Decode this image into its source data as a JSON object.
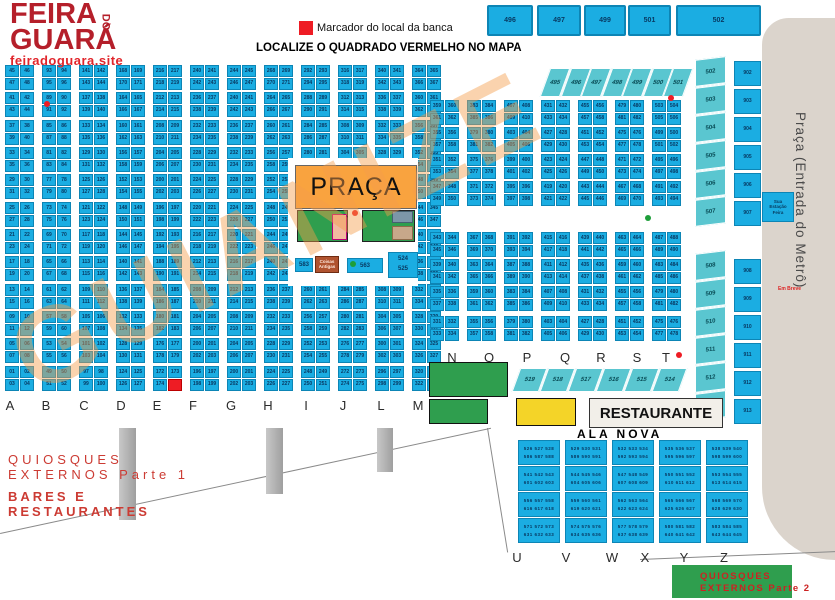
{
  "logo": {
    "line1": "FEIRA",
    "do": "DO",
    "line2": "GUARÁ",
    "site": "feiradoguara.site"
  },
  "legend": {
    "label": "Marcador do local da banca"
  },
  "heading": "LOCALIZE O QUADRADO VERMELHO NO MAPA",
  "watermark_text": "GUIANIZE",
  "colors": {
    "cell": "#1bade2",
    "cell_border": "#0d85b5",
    "marker_red": "#ee1c24",
    "teal": "#5ac6d0",
    "praca_orange": "#f9a33f",
    "green": "#2f9e4e",
    "yellow": "#f4d428",
    "metro_gray": "#dbd4cc",
    "brown": "#b0532f",
    "logo_red": "#b51f2a"
  },
  "top_boxes": [
    {
      "label": "496",
      "x": 487,
      "w": 46
    },
    {
      "label": "497",
      "x": 537,
      "w": 44
    },
    {
      "label": "499",
      "x": 584,
      "w": 42
    },
    {
      "label": "501",
      "x": 628,
      "w": 43
    },
    {
      "label": "502",
      "x": 676,
      "w": 85
    }
  ],
  "left_grid": {
    "block_tops": [
      65,
      92,
      120,
      147,
      174,
      202,
      229,
      256,
      284,
      311,
      338,
      366
    ],
    "cell_w": 14,
    "cell_h": 12,
    "row2_dy": 12.5,
    "letters_y": 398,
    "groups": [
      {
        "letter": "A",
        "x": 5,
        "lx": 10,
        "start": 1
      },
      {
        "letter": "B",
        "x": 42,
        "lx": 46,
        "start": 49
      },
      {
        "letter": "C",
        "x": 79,
        "lx": 84,
        "start": 97
      },
      {
        "letter": "D",
        "x": 116,
        "lx": 121,
        "start": 124
      },
      {
        "letter": "E",
        "x": 153,
        "lx": 157,
        "start": 172
      },
      {
        "letter": "F",
        "x": 190,
        "lx": 193,
        "start": 196
      },
      {
        "letter": "G",
        "x": 227,
        "lx": 231,
        "start": 200
      },
      {
        "letter": "H",
        "x": 264,
        "lx": 268,
        "start": 224
      },
      {
        "letter": "I",
        "x": 301,
        "lx": 306,
        "start": 248
      },
      {
        "letter": "J",
        "x": 338,
        "lx": 343,
        "start": 272
      },
      {
        "letter": "L",
        "x": 375,
        "lx": 381,
        "start": 296
      },
      {
        "letter": "M",
        "x": 412,
        "lx": 418,
        "start": 320
      }
    ]
  },
  "right_grid": {
    "block_tops": [
      100,
      127,
      154,
      181,
      232,
      259,
      286,
      316
    ],
    "cell_w": 14,
    "cell_h": 12,
    "row2_dy": 12.5,
    "letters_y": 350,
    "groups": [
      {
        "letter": "N",
        "x": 430,
        "lx": 452,
        "start": 331
      },
      {
        "letter": "O",
        "x": 467,
        "lx": 489,
        "start": 355
      },
      {
        "letter": "P",
        "x": 504,
        "lx": 527,
        "start": 379
      },
      {
        "letter": "Q",
        "x": 541,
        "lx": 565,
        "start": 403
      },
      {
        "letter": "R",
        "x": 578,
        "lx": 601,
        "start": 427
      },
      {
        "letter": "S",
        "x": 615,
        "lx": 637,
        "start": 451
      },
      {
        "letter": "T",
        "x": 652,
        "lx": 666,
        "start": 475
      }
    ]
  },
  "red_marker": {
    "group_letter": "E",
    "group_index": 4,
    "position": "bottom-right"
  },
  "slant_top": {
    "labels": [
      "495",
      "496",
      "497",
      "498",
      "499",
      "500",
      "501"
    ],
    "x0": 545,
    "step": 20.5,
    "y": 68,
    "w": 20,
    "h": 29
  },
  "slant_bottom": {
    "labels": [
      "519",
      "518",
      "517",
      "516",
      "515",
      "514"
    ],
    "x0": 516,
    "step": 28,
    "y": 368,
    "w": 27,
    "h": 24
  },
  "teal_col": {
    "labels": [
      "502",
      "503",
      "504",
      "505",
      "506",
      "507",
      "508",
      "509",
      "510",
      "511",
      "512",
      "513"
    ],
    "x": 695,
    "w": 31,
    "y0": 58,
    "h": 27,
    "step": 28,
    "gap_after": 6,
    "gap": 26
  },
  "blue_col": {
    "labels": [
      "902",
      "903",
      "904",
      "905",
      "906",
      "907",
      "908",
      "909",
      "910",
      "911",
      "912",
      "913"
    ],
    "x": 734,
    "w": 27,
    "y0": 61,
    "h": 25,
    "step": 28,
    "gap_after": 6,
    "gap": 30
  },
  "praca": {
    "title": "PRAÇA",
    "box583": "583",
    "coisas": "Coisas Antigas",
    "box563": "563",
    "box524": "524",
    "box525": "525"
  },
  "metro": {
    "label": "Praça (Entrada do Metrô)",
    "em_breve": "Em Breve",
    "estacao": {
      "0": "Sua",
      "1": "Estação",
      "2": "Feira"
    }
  },
  "restaurante_label": "RESTAURANTE",
  "ala_nova": {
    "title": "ALA NOVA",
    "start": 526,
    "line2_offset": 60,
    "col_x": [
      518,
      565,
      612,
      659,
      706
    ],
    "row_y": [
      440,
      466,
      492,
      518
    ],
    "block_w": 40,
    "block_h": 23,
    "letters": [
      {
        "ch": "U",
        "x": 517
      },
      {
        "ch": "V",
        "x": 566
      },
      {
        "ch": "W",
        "x": 612
      },
      {
        "ch": "X",
        "x": 645
      },
      {
        "ch": "Y",
        "x": 684
      },
      {
        "ch": "Z",
        "x": 724
      }
    ],
    "letters_y": 550
  },
  "quiosques1": {
    "l1": "QUIOSQUES",
    "l2": "EXTERNOS Parte 1",
    "l3": "BARES E",
    "l4": "RESTAURANTES"
  },
  "quiosques2": {
    "l1": "QUIOSQUES",
    "l2": "EXTERNOS Parte 2"
  },
  "dots": [
    {
      "x": 44,
      "y": 101,
      "color": "#ee1c24"
    },
    {
      "x": 668,
      "y": 95,
      "color": "#ee1c24"
    },
    {
      "x": 645,
      "y": 215,
      "color": "#1e9e3a"
    },
    {
      "x": 676,
      "y": 352,
      "color": "#ee1c24"
    },
    {
      "x": 352,
      "y": 210,
      "color": "#ee1c24"
    },
    {
      "x": 350,
      "y": 261,
      "color": "#1e9e3a"
    }
  ],
  "pillars": [
    {
      "x": 119,
      "y": 428,
      "w": 17,
      "h": 92
    },
    {
      "x": 266,
      "y": 428,
      "w": 17,
      "h": 66
    },
    {
      "x": 377,
      "y": 428,
      "w": 16,
      "h": 44
    }
  ],
  "lines": [
    {
      "x": 0,
      "y": 533,
      "len": 502,
      "angle": -12.1
    },
    {
      "x": 488,
      "y": 428,
      "len": 126,
      "angle": 80.8
    },
    {
      "x": 640,
      "y": 559,
      "len": 196,
      "angle": -2.3
    }
  ],
  "green_boxes": [
    {
      "x": 429,
      "y": 362,
      "w": 77,
      "h": 33
    },
    {
      "x": 429,
      "y": 399,
      "w": 57,
      "h": 23
    }
  ]
}
